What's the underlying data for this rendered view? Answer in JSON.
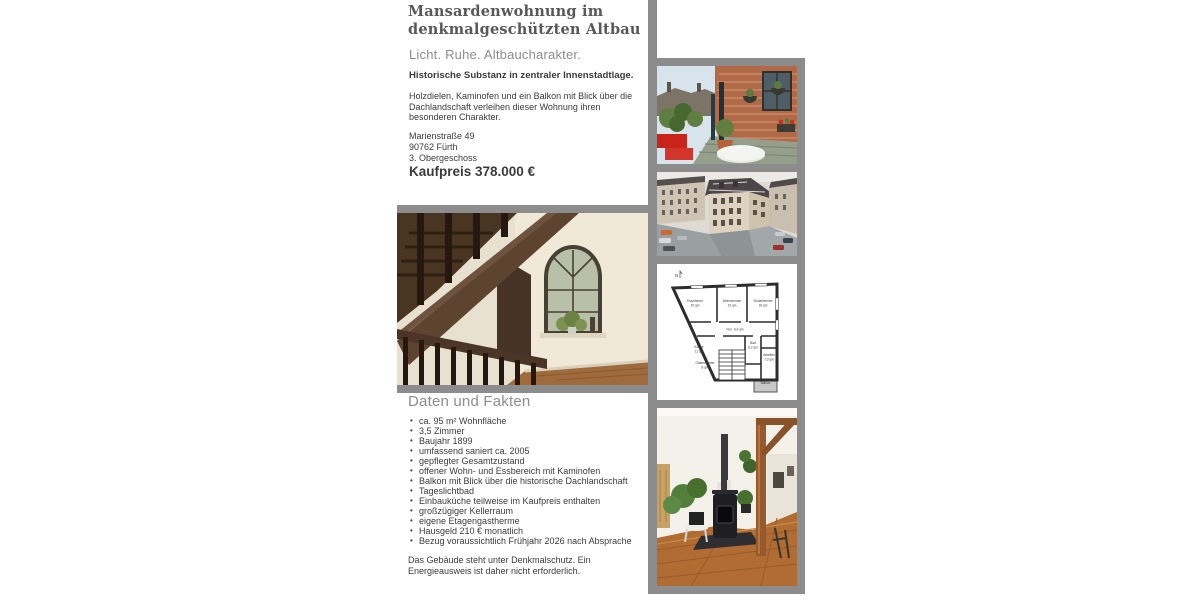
{
  "page": {
    "title": "Mansardenwohnung im\ndenkmalgeschützten Altbau",
    "subtitle": "Licht. Ruhe. Altbaucharakter.",
    "lead": "Historische Substanz in zentraler Innenstadtlage.",
    "description": "Holzdielen, Kaminofen und ein Balkon mit Blick über die Dachlandschaft verleihen dieser Wohnung ihren besonderen Charakter.",
    "address": [
      "Marienstraße 49",
      "90762 Fürth",
      "3. Obergeschoss"
    ],
    "price": "Kaufpreis 378.000 €"
  },
  "facts": {
    "heading": "Daten und Fakten",
    "items": [
      "ca. 95 m² Wohnfläche",
      "3,5 Zimmer",
      "Baujahr 1899",
      "umfassend saniert ca. 2005",
      "gepflegter Gesamtzustand",
      "offener Wohn- und Essbereich mit Kaminofen",
      "Balkon mit Blick über die historische Dachlandschaft",
      "Tageslichtbad",
      "Einbauküche teilweise im Kaufpreis enthalten",
      "großzügiger Kellerraum",
      "eigene Etagengastherme",
      "Hausgeld 210 € monatlich",
      "Bezug voraussichtlich Frühjahr 2026 nach Absprache"
    ],
    "note": "Das Gebäude steht unter Denkmalschutz. Ein Energieausweis ist daher nicht erforderlich."
  },
  "floorplan": {
    "north_label": "N",
    "rooms": [
      {
        "name": "Esszimmer",
        "size": "20 qm"
      },
      {
        "name": "Wohnzimmer",
        "size": "19 qm"
      },
      {
        "name": "Schlafzimmer",
        "size": "18 qm"
      },
      {
        "name": "Flur",
        "size": "6,4 qm"
      },
      {
        "name": "Küche",
        "size": "11 qm"
      },
      {
        "name": "Gästezimmer",
        "size": "8 qm"
      },
      {
        "name": "Bad",
        "size": "6,2 qm"
      },
      {
        "name": "Arbeiten",
        "size": "7,3 qm"
      },
      {
        "name": "Balkon",
        "size": ""
      }
    ]
  },
  "photos": {
    "staircase": "treppenhaus-mit-rundbogenfenster",
    "balcony": "dachbalkon-mit-dachlandschaft",
    "street": "eckgebaeude-strassenansicht",
    "floorplan": "wohnungsgrundriss",
    "interior": "wohnbereich-mit-kaminofen"
  },
  "colors": {
    "frame": "#8c8c8c",
    "heading_gray": "#8d8d8d",
    "text": "#3b3b3b",
    "title": "#585858"
  }
}
